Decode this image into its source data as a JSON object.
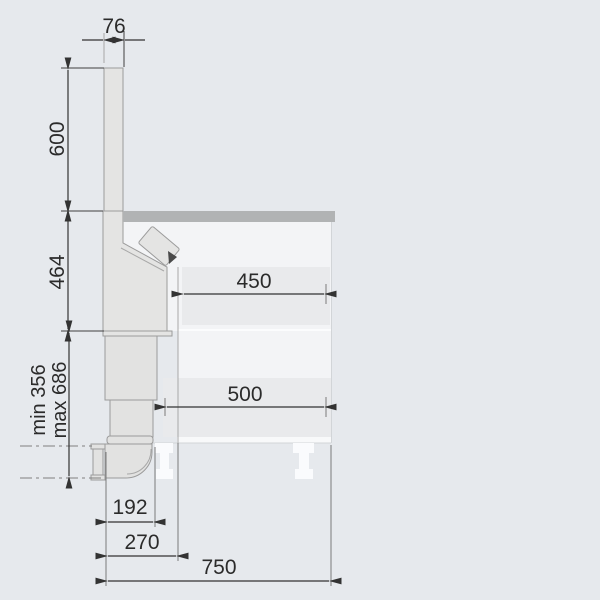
{
  "diagram": {
    "type": "technical-installation-drawing",
    "view": "side-section of downdraft extractor in kitchen cabinet",
    "labels": {
      "d76": "76",
      "d600": "600",
      "d464": "464",
      "dmin": "min 356",
      "dmax": "max 686",
      "d450": "450",
      "d500": "500",
      "d192": "192",
      "d270": "270",
      "d750": "750"
    },
    "colors": {
      "background": "#e6e9ed",
      "panel": "#e4e4e3",
      "panel_outline": "#9b9b9b",
      "countertop": "#b1b3b4",
      "cabinet_interior": "#f3f4f6",
      "drawer_band": "#e9eaec",
      "bottom_strip": "#f8f9fa",
      "duct": "#e2e2e1",
      "leg": "#fafbfd",
      "dimension_line": "#333333",
      "text": "#2b2b2b",
      "detail_dark": "#4a4a4a"
    }
  }
}
